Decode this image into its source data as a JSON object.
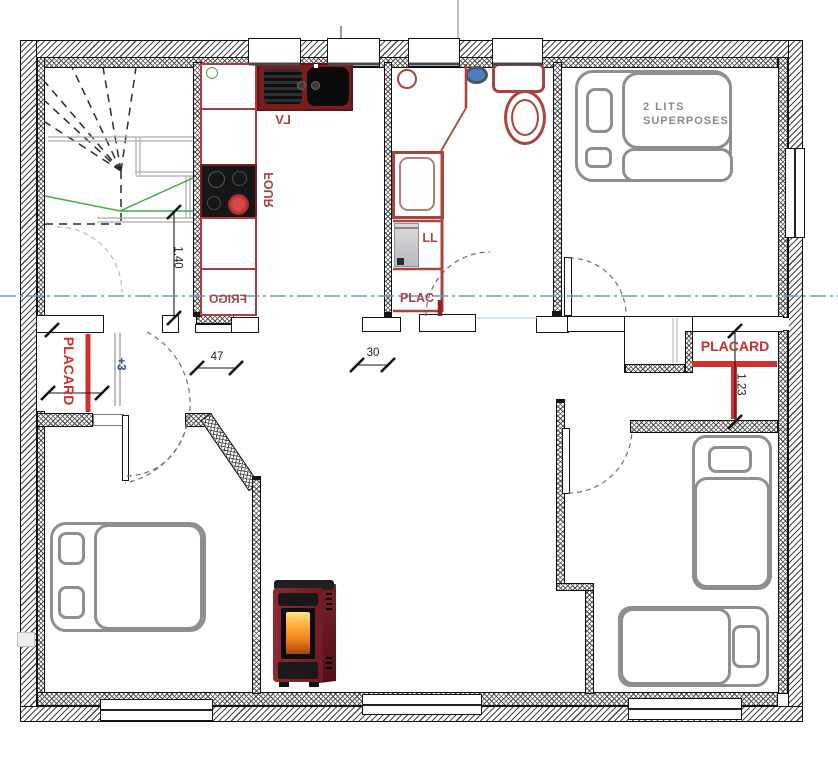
{
  "plan": {
    "kitchen": {
      "sink_label": "LV",
      "oven_label": "FOUR",
      "fridge_label": "FRIGO"
    },
    "bathroom": {
      "closet_label": "PLAC",
      "washer_label": "LL"
    },
    "bedroom_bunk": {
      "label_line1": "2 LITS",
      "label_line2": "SUPERPOSES"
    },
    "closets": {
      "left_label": "PLACARD",
      "right_label": "PLACARD"
    },
    "dimensions": {
      "stair_width": "1.40",
      "hall_opening": "47",
      "bath_opening": "30",
      "right_closet": "1.23",
      "level_mark": "+3"
    }
  },
  "colors": {
    "accent_red": "#cf2e2e",
    "counter_red": "#a93e3e",
    "fixture_red": "#a8453f",
    "dark_red": "#7c1d1d",
    "furniture_gray": "#8f8f8f",
    "label_gray": "#8a8a8a",
    "axis_blue": "#5b9bd5",
    "stair_green": "#3fae4a",
    "dim_navy": "#2e4a8f",
    "door_arc": "#6a7086",
    "wall_ink": "#111111"
  }
}
